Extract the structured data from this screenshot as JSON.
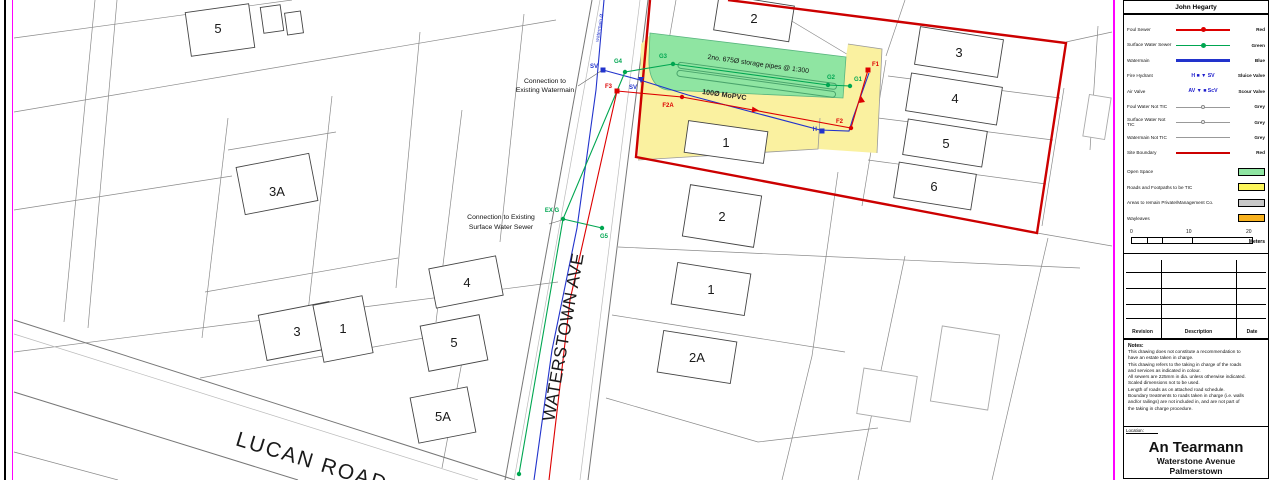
{
  "sheet": {
    "author": "John Hegarty",
    "location_label": "Location:",
    "location_lines": [
      "An Tearmann",
      "Waterstone Avenue",
      "Palmerstown"
    ]
  },
  "legend": {
    "rows": [
      {
        "label": "Foul Sewer",
        "right": "Red"
      },
      {
        "label": "Surface Water Sewer",
        "right": "Green"
      },
      {
        "label": "Watermain",
        "right": "Blue"
      },
      {
        "label": "Fire Hydrant",
        "sym": "H ■   ▼ SV",
        "right": "Sluice Valve"
      },
      {
        "label": "Air Valve",
        "sym": "AV ▼   ■ ScV",
        "right": "Scour Valve"
      },
      {
        "label": "Foul Water Not TIC",
        "right": "Grey"
      },
      {
        "label": "Surface Water Not TIC",
        "right": "Grey"
      },
      {
        "label": "Watermain Not TIC",
        "right": "Grey"
      },
      {
        "label": "Site Boundary",
        "right": "Red"
      }
    ],
    "areas": [
      {
        "label": "Open Space",
        "color": "#8fe5a2"
      },
      {
        "label": "Roads and Footpaths to be TIC",
        "color": "#fdf65a"
      },
      {
        "label": "Areas to remain Private/Management Co.",
        "color": "#c9c9c9"
      },
      {
        "label": "Wayleaves",
        "color": "#f7b11e"
      }
    ],
    "scale": {
      "t0": "0",
      "t1": "10",
      "t2": "20",
      "unit": "Meters"
    }
  },
  "revisions": {
    "col1": "Revision",
    "col2": "Description",
    "col3": "Date"
  },
  "notes": {
    "title": "Notes:",
    "lines": [
      "This drawing does not constitute a recommendation to",
      "have an estate taken in charge.",
      "This drawing refers to the taking in charge of the roads",
      "and services as indicated in colour.",
      "All sewers are 225mm in dia. unless otherwise indicated.",
      "Scaled dimensions not to be used.",
      "Length of roads as on attached road schedule.",
      "Boundary treatments to roads taken in charge (i.e. walls",
      "and/or railings) are not included in, and are not part of",
      "the taking in charge procedure."
    ]
  },
  "map": {
    "streets": {
      "waterstown": "WATERSTOWN AVE",
      "lucan": "LUCAN ROAD",
      "watermain_note": "watermain Ø"
    },
    "ann_watermain": {
      "l1": "Connection to",
      "l2": "Existing Watermain"
    },
    "ann_surface": {
      "l1": "Connection to Existing",
      "l2": "Surface Water Sewer"
    },
    "storage_note": "2no. 675Ø storage pipes @ 1:300",
    "pipe_note": "100Ø MoPVC",
    "plots": {
      "p5": "5",
      "p3a": "3A",
      "p3": "3",
      "p1": "1",
      "p4": "4",
      "p5b": "5",
      "p5a": "5A",
      "r2t": "2",
      "r3": "3",
      "r4": "4",
      "r5": "5",
      "r6": "6",
      "r2m": "2",
      "r1": "1",
      "r2a": "2A",
      "site1": "1"
    },
    "svc": {
      "g1": "G1",
      "g2": "G2",
      "g3": "G3",
      "g4": "G4",
      "g5": "G5",
      "exg": "EX G",
      "f1": "F1",
      "f2": "F2",
      "f2a": "F2A",
      "f3": "F3",
      "sv1": "SV",
      "sv2": "SV",
      "h": "H"
    }
  },
  "colors": {
    "foul": "#dd0000",
    "surface": "#00a651",
    "watermain": "#2233cc",
    "boundary": "#cc0000",
    "magenta": "#ff00ff"
  }
}
